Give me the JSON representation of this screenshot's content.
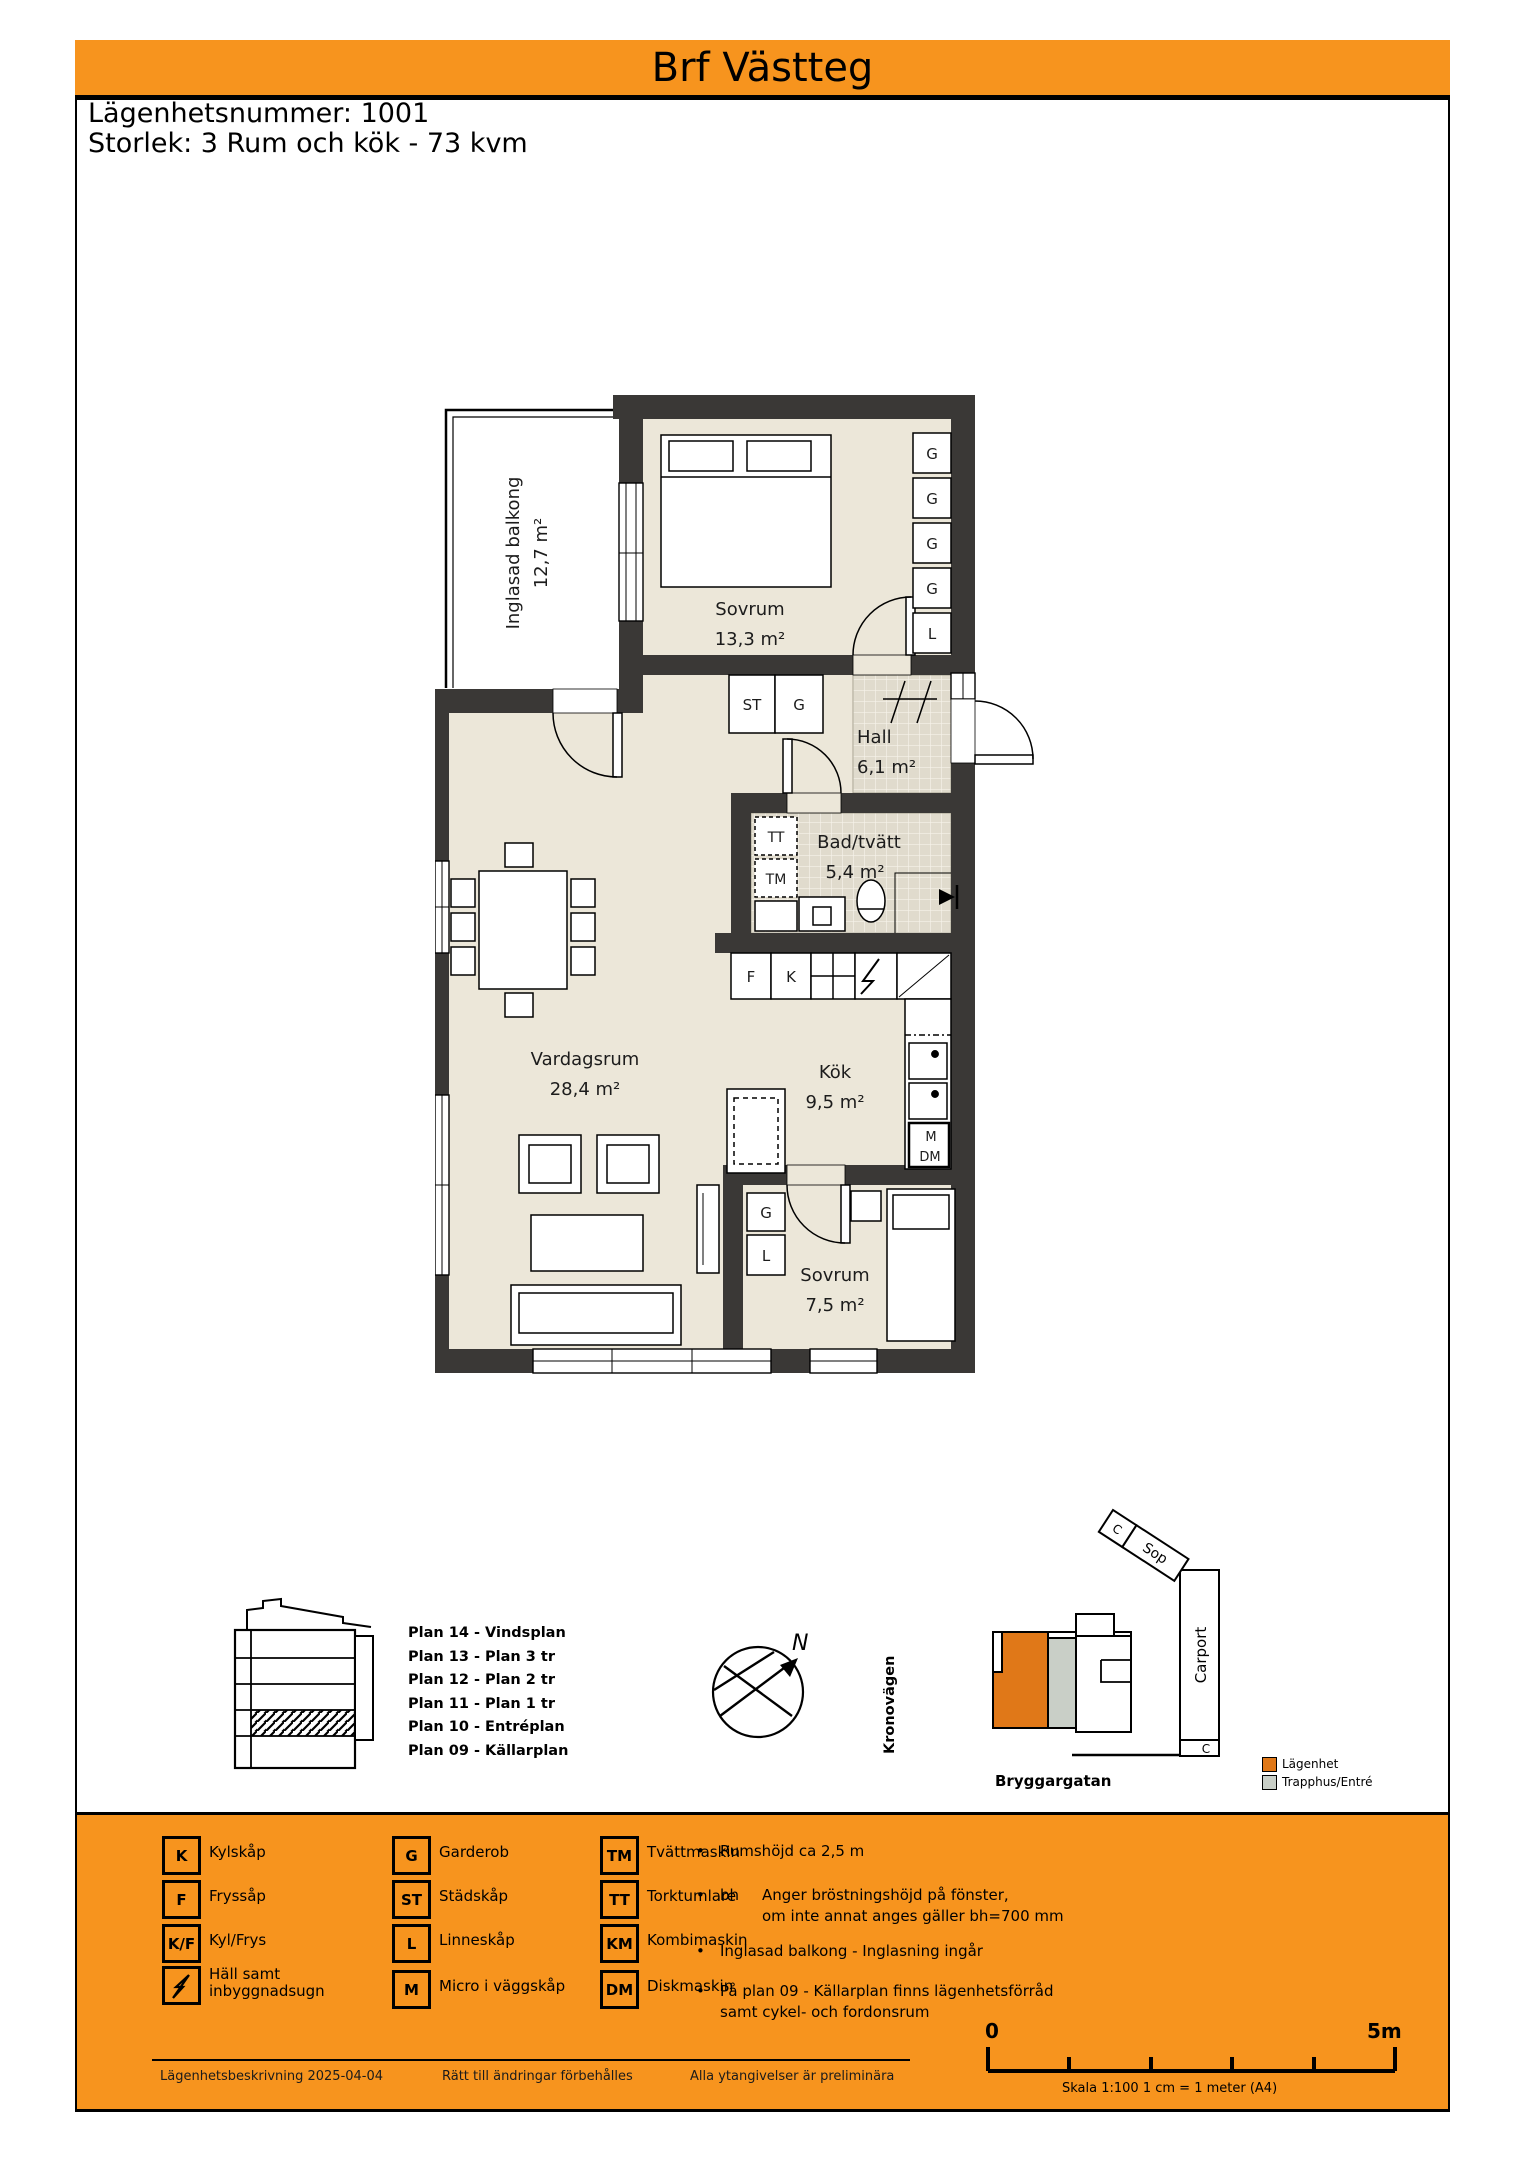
{
  "colors": {
    "accent_orange": "#f7941e",
    "wall": "#3a3836",
    "floor_beige": "#ece7d9",
    "tile": "#e0dbcd",
    "site_apartment": "#e07818",
    "site_stairwell": "#c9cfc7"
  },
  "header": {
    "title": "Brf Västteg"
  },
  "apartment_info": {
    "number": "Lägenhetsnummer: 1001",
    "size": "Storlek: 3 Rum och kök - 73 kvm"
  },
  "floor_plan": {
    "rooms": {
      "balcony": {
        "name": "Inglasad balkong",
        "area": "12,7 m²"
      },
      "bedroom1": {
        "name": "Sovrum",
        "area": "13,3 m²"
      },
      "hall": {
        "name": "Hall",
        "area": "6,1 m²"
      },
      "bath": {
        "name": "Bad/tvätt",
        "area": "5,4 m²"
      },
      "living": {
        "name": "Vardagsrum",
        "area": "28,4 m²"
      },
      "kitchen": {
        "name": "Kök",
        "area": "9,5 m²"
      },
      "bedroom2": {
        "name": "Sovrum",
        "area": "7,5 m²"
      }
    },
    "letters": {
      "g": "G",
      "l": "L",
      "st": "ST",
      "tt": "TT",
      "tm": "TM",
      "f": "F",
      "k": "K",
      "m": "M",
      "dm": "DM"
    }
  },
  "building_section": {
    "plans": [
      "Plan 14 - Vindsplan",
      "Plan 13 - Plan 3 tr",
      "Plan 12 - Plan 2 tr",
      "Plan 11 - Plan 1 tr",
      "Plan 10 - Entréplan",
      "Plan 09 - Källarplan"
    ]
  },
  "compass": {
    "north": "N"
  },
  "site_plan": {
    "street_left": "Kronovägen",
    "street_bottom": "Bryggargatan",
    "carport": "Carport",
    "garbage": "Sop",
    "c_label": "C",
    "legend": [
      {
        "label": "Lägenhet"
      },
      {
        "label": "Trapphus/Entré"
      }
    ]
  },
  "symbol_legend": {
    "items": [
      {
        "key": "K",
        "label": "Kylskåp"
      },
      {
        "key": "F",
        "label": "Fryssåp"
      },
      {
        "key": "K/F",
        "label": "Kyl/Frys"
      },
      {
        "key": "",
        "label1": "Häll samt",
        "label2": "inbyggnadsugn"
      },
      {
        "key": "G",
        "label": "Garderob"
      },
      {
        "key": "ST",
        "label": "Städskåp"
      },
      {
        "key": "L",
        "label": "Linneskåp"
      },
      {
        "key": "M",
        "label": "Micro i väggskåp"
      },
      {
        "key": "TM",
        "label": "Tvättmaskin"
      },
      {
        "key": "TT",
        "label": "Torktumlare"
      },
      {
        "key": "KM",
        "label": "Kombimaskin"
      },
      {
        "key": "DM",
        "label": "Diskmaskin"
      }
    ]
  },
  "notes": [
    {
      "term": "",
      "line1": "Rumshöjd ca 2,5 m",
      "line2": ""
    },
    {
      "term": "bh",
      "line1": "Anger bröstningshöjd på fönster,",
      "line2": "om inte annat anges gäller bh=700 mm"
    },
    {
      "term": "",
      "line1": "Inglasad balkong - Inglasning ingår",
      "line2": ""
    },
    {
      "term": "",
      "line1": "På plan 09 - Källarplan finns lägenhetsförråd",
      "line2": "samt cykel- och fordonsrum"
    }
  ],
  "scale_bar": {
    "start": "0",
    "end": "5m",
    "caption": "Skala 1:100 1 cm = 1 meter (A4)"
  },
  "footer": {
    "left": "Lägenhetsbeskrivning 2025-04-04",
    "center": "Rätt till ändringar förbehålles",
    "right": "Alla ytangivelser är preliminära"
  }
}
